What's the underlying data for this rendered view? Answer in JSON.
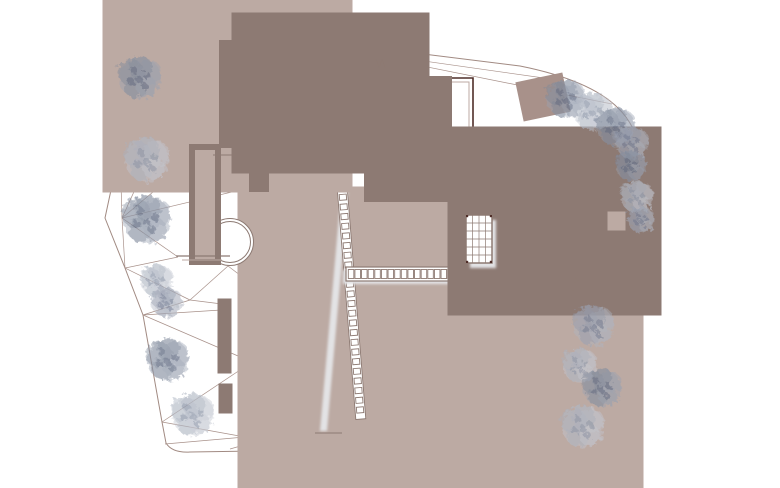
{
  "canvas": {
    "width": 780,
    "height": 488,
    "background": "#ffffff"
  },
  "palette": {
    "bound": "#a18a82",
    "mesh": "#a8918a",
    "dark": "#4f2e29",
    "med": "#8d7a73",
    "light": "#bcaaa3",
    "shadow": "#e3e3e5",
    "poolshadow": "#d9d9db",
    "white": "#ffffff",
    "tree_light": [
      "#c3c8d2",
      "#aab1bf",
      "#8a93a6"
    ],
    "tree_mid": [
      "#b0b6c2",
      "#949cad",
      "#6f7990"
    ],
    "tree_dark": [
      "#9aa2b2",
      "#7e8799",
      "#5c667e"
    ]
  },
  "site": {
    "boundary_path": "M132,18 L520,66 Q590,80 618,108 Q643,132 643,178 Q643,230 634,282 Q627,330 612,387 Q601,424 566,440 Q552,447 536,447 L190,452 Q172,453 166,443 L162,422 L143,315 L125,268 L105,218 L120,148 Z",
    "mesh_segments": [
      [
        132,
        18,
        233,
        28
      ],
      [
        233,
        28,
        612,
        104
      ],
      [
        132,
        18,
        346,
        50
      ],
      [
        346,
        50,
        558,
        80
      ],
      [
        233,
        28,
        384,
        57
      ],
      [
        233,
        28,
        165,
        58
      ],
      [
        233,
        28,
        290,
        60
      ],
      [
        290,
        60,
        346,
        50
      ],
      [
        132,
        18,
        131,
        58
      ],
      [
        131,
        58,
        165,
        58
      ],
      [
        131,
        58,
        120,
        148
      ],
      [
        131,
        58,
        163,
        128
      ],
      [
        165,
        58,
        163,
        128
      ],
      [
        163,
        128,
        120,
        148
      ],
      [
        163,
        128,
        122,
        218
      ],
      [
        120,
        148,
        122,
        218
      ],
      [
        122,
        218,
        197,
        155
      ],
      [
        122,
        218,
        253,
        187
      ],
      [
        122,
        218,
        178,
        257
      ],
      [
        122,
        218,
        125,
        268
      ],
      [
        125,
        268,
        190,
        300
      ],
      [
        190,
        300,
        143,
        315
      ],
      [
        190,
        300,
        222,
        304
      ],
      [
        190,
        300,
        228,
        266
      ],
      [
        143,
        315,
        221,
        310
      ],
      [
        143,
        315,
        252,
        362
      ],
      [
        162,
        422,
        252,
        362
      ],
      [
        162,
        422,
        245,
        437
      ],
      [
        165,
        444,
        245,
        437
      ],
      [
        245,
        437,
        310,
        416
      ],
      [
        310,
        416,
        253,
        433
      ],
      [
        230,
        449,
        300,
        429
      ],
      [
        300,
        429,
        347,
        442
      ],
      [
        347,
        442,
        425,
        427
      ],
      [
        425,
        427,
        487,
        441
      ],
      [
        487,
        441,
        545,
        430
      ],
      [
        228,
        266,
        270,
        298
      ],
      [
        178,
        257,
        125,
        268
      ]
    ]
  },
  "scene": [
    {
      "name": "terrace-upper-shadow",
      "t": "poly",
      "pts": "298,277 392,277 392,288 298,288",
      "f": "shadow",
      "blur": 1
    },
    {
      "name": "terrace-slab-shadow",
      "t": "poly",
      "pts": "252,433 558,430 558,440 248,442",
      "f": "shadow",
      "blur": 1
    },
    {
      "name": "terrace-slab",
      "t": "poly",
      "pts": "273,291 334,288 558,288 558,430 252,433",
      "f": "#ffffff",
      "c": "light"
    },
    {
      "name": "terrace-top-edge",
      "t": "line",
      "p": [
        298,
        288,
        334,
        287
      ],
      "c": "dark",
      "w": 1.2
    },
    {
      "name": "terrace-left-inner-edge",
      "t": "line",
      "p": [
        276,
        295,
        256,
        429
      ],
      "c": "light"
    },
    {
      "name": "pool-shadow",
      "t": "path",
      "d": "M334,417 H547 V295 L563,307 V439 H316 Z",
      "f": "poolshadow",
      "blur": 2
    },
    {
      "name": "pool",
      "t": "rect",
      "x": 334,
      "y": 283,
      "w": 213,
      "h": 134,
      "c": "dark",
      "sw": 2.4,
      "f": "#ffffff"
    },
    {
      "name": "pool-inner-edge",
      "t": "rect",
      "x": 339,
      "y": 288,
      "w": 203,
      "h": 124,
      "c": "light"
    },
    {
      "name": "main-stair-shadow",
      "t": "poly",
      "pts": "345,148 352,148 327,431 320,431",
      "f": "shadow",
      "blur": 1
    },
    {
      "name": "main-stair",
      "t": "ladder",
      "x": 338.5,
      "y": 142,
      "len": 278,
      "wd": 10,
      "tilt": -4.6,
      "rungs": 28,
      "c": "med"
    },
    {
      "name": "garden-steps-shadow",
      "t": "rect",
      "x": 343,
      "y": 270,
      "w": 109,
      "h": 14,
      "f": "shadow",
      "blur": 1
    },
    {
      "name": "garden-steps",
      "t": "strip",
      "x": 346,
      "y": 267,
      "w": 109,
      "h": 14,
      "cells": 16,
      "c": "med"
    },
    {
      "name": "lower-steps-1",
      "t": "line",
      "p": [
        315,
        433,
        342,
        433
      ],
      "c": "med"
    },
    {
      "name": "lower-steps-2",
      "t": "line",
      "p": [
        318,
        436,
        339,
        436
      ],
      "c": "light"
    },
    {
      "name": "lower-steps-3",
      "t": "line",
      "p": [
        321,
        439,
        336,
        439
      ],
      "c": "light"
    },
    {
      "name": "annex-outline",
      "t": "rect",
      "x": 165,
      "y": 60,
      "w": 125,
      "h": 70,
      "c": "light"
    },
    {
      "name": "annex-division",
      "t": "rect",
      "x": 238,
      "y": 59,
      "w": 38,
      "h": 70,
      "c": "med"
    },
    {
      "name": "building-a-shadow",
      "t": "rect",
      "x": 287,
      "y": 70,
      "w": 107,
      "h": 70,
      "f": "shadow",
      "blur": 1
    },
    {
      "name": "building-a",
      "t": "rect",
      "x": 277,
      "y": 58,
      "w": 107,
      "h": 70,
      "c": "dark",
      "sw": 1.8,
      "f": "#ffffff"
    },
    {
      "name": "building-a-inner",
      "t": "rect",
      "x": 281,
      "y": 62,
      "w": 99,
      "h": 62,
      "c": "med"
    },
    {
      "name": "entry-steps",
      "t": "rect",
      "x": 386,
      "y": 60,
      "w": 22,
      "h": 16,
      "c": "med",
      "f": "#ffffff"
    },
    {
      "name": "entry-steps-2",
      "t": "rect",
      "x": 389,
      "y": 63,
      "w": 16,
      "h": 10,
      "c": "med"
    },
    {
      "name": "entry-steps-3",
      "t": "rect",
      "x": 392,
      "y": 66,
      "w": 10,
      "h": 4,
      "c": "med"
    },
    {
      "name": "entry-mark",
      "t": "polyline",
      "pts": "376,59 379,68 382,59 385,68",
      "c": "med",
      "w": 0.8
    },
    {
      "name": "roof-edge",
      "t": "polyline",
      "pts": "384,78 473,78 473,177",
      "c": "dark",
      "w": 1.6
    },
    {
      "name": "roof-edge-inner",
      "t": "polyline",
      "pts": "384,82 469,82 469,177",
      "c": "light"
    },
    {
      "name": "stair-hall-shadow",
      "t": "rect",
      "x": 392,
      "y": 106,
      "w": 44,
      "h": 82,
      "f": "shadow",
      "blur": 1
    },
    {
      "name": "stair-hall",
      "t": "rect",
      "x": 386,
      "y": 98,
      "w": 44,
      "h": 82,
      "c": "med",
      "f": "#ffffff"
    },
    {
      "name": "flue-line",
      "t": "polyline",
      "pts": "500,146 511,146 511,177",
      "c": "med"
    },
    {
      "name": "building-b-shadow",
      "t": "rect",
      "x": 505,
      "y": 188,
      "w": 115,
      "h": 90,
      "f": "shadow",
      "blur": 1
    },
    {
      "name": "building-b",
      "t": "rect",
      "x": 497,
      "y": 176,
      "w": 115,
      "h": 90,
      "c": "dark",
      "sw": 1.8,
      "f": "#ffffff"
    },
    {
      "name": "building-b-inner",
      "t": "rect",
      "x": 501,
      "y": 180,
      "w": 107,
      "h": 82,
      "c": "med"
    },
    {
      "name": "building-b-notch",
      "t": "rect",
      "x": 612,
      "y": 216,
      "w": 9,
      "h": 10,
      "c": "light",
      "f": "#ffffff"
    },
    {
      "name": "skylight-shadow",
      "t": "rect",
      "x": 470,
      "y": 220,
      "w": 26,
      "h": 48,
      "f": "shadow",
      "blur": 1
    },
    {
      "name": "skylight-grid",
      "t": "grid",
      "x": 466,
      "y": 215,
      "w": 26,
      "h": 48,
      "cols": 4,
      "rows": 6,
      "c": "med"
    },
    {
      "name": "stair-b-rail",
      "t": "line",
      "p": [
        585,
        262,
        585,
        310
      ],
      "c": "med"
    },
    {
      "name": "stair-b",
      "t": "rect",
      "x": 563,
      "y": 276,
      "w": 6,
      "h": 28,
      "c": "med",
      "f": "#ffffff"
    },
    {
      "name": "stair-b-rung-1",
      "t": "line",
      "p": [
        563,
        285,
        569,
        285
      ],
      "c": "med"
    },
    {
      "name": "stair-b-rung-2",
      "t": "line",
      "p": [
        563,
        294,
        569,
        294
      ],
      "c": "med"
    },
    {
      "name": "stair-b-frame",
      "t": "polyline",
      "pts": "572,296 577,275 582,296",
      "c": "med"
    },
    {
      "name": "stair-b-bar",
      "t": "line",
      "p": [
        573,
        285,
        581,
        285
      ],
      "c": "med"
    },
    {
      "name": "stair-b-tick",
      "t": "line",
      "p": [
        556,
        283,
        563,
        283
      ],
      "c": "med"
    },
    {
      "name": "gate-outline",
      "t": "rect",
      "x": 531,
      "y": 89,
      "w": 24,
      "h": 16,
      "c": "mesh",
      "rot": [
        -12,
        543,
        97
      ]
    },
    {
      "name": "spiral-court",
      "t": "circle",
      "cx": 230,
      "cy": 242,
      "r": 23.5,
      "c": "med",
      "f": "#ffffff"
    },
    {
      "name": "spiral-court-inner",
      "t": "circle",
      "cx": 230,
      "cy": 242,
      "r": 20.5,
      "c": "med"
    },
    {
      "name": "garden-wall",
      "t": "rect",
      "x": 197,
      "y": 152,
      "w": 16,
      "h": 105,
      "c": "med",
      "f": "#ffffff"
    },
    {
      "name": "garden-wall-inner",
      "t": "rect",
      "x": 200,
      "y": 155,
      "w": 10,
      "h": 99,
      "c": "light"
    },
    {
      "name": "garden-pier",
      "t": "rect",
      "x": 254,
      "y": 152,
      "w": 10,
      "h": 35,
      "c": "med",
      "f": "#ffffff"
    },
    {
      "name": "wall-connector",
      "t": "line",
      "p": [
        213,
        155,
        254,
        155
      ],
      "c": "med"
    },
    {
      "name": "bench",
      "t": "line",
      "p": [
        176,
        256,
        230,
        256
      ],
      "c": "med",
      "w": 1.2
    },
    {
      "name": "bench-shadow-line",
      "t": "line",
      "p": [
        182,
        260,
        222,
        260
      ],
      "c": "light"
    },
    {
      "name": "retaining-wall-a",
      "t": "rect",
      "x": 221,
      "y": 302,
      "w": 7,
      "h": 68,
      "c": "med",
      "f": "#ffffff"
    },
    {
      "name": "retaining-wall-b",
      "t": "rect",
      "x": 222,
      "y": 387,
      "w": 7,
      "h": 23,
      "c": "med",
      "f": "#ffffff"
    }
  ],
  "trees": [
    {
      "cx": 140,
      "cy": 78,
      "r": 21,
      "tone": "dark"
    },
    {
      "cx": 147,
      "cy": 160,
      "r": 22,
      "tone": "light"
    },
    {
      "cx": 147,
      "cy": 220,
      "r": 24,
      "tone": "dark"
    },
    {
      "cx": 157,
      "cy": 281,
      "r": 16,
      "tone": "light"
    },
    {
      "cx": 167,
      "cy": 303,
      "r": 15,
      "tone": "mid"
    },
    {
      "cx": 168,
      "cy": 360,
      "r": 21,
      "tone": "dark"
    },
    {
      "cx": 193,
      "cy": 415,
      "r": 21,
      "tone": "light"
    },
    {
      "cx": 566,
      "cy": 99,
      "r": 19,
      "tone": "dark"
    },
    {
      "cx": 593,
      "cy": 112,
      "r": 19,
      "tone": "light"
    },
    {
      "cx": 616,
      "cy": 127,
      "r": 19,
      "tone": "dark"
    },
    {
      "cx": 632,
      "cy": 143,
      "r": 16,
      "tone": "mid"
    },
    {
      "cx": 631,
      "cy": 166,
      "r": 15,
      "tone": "dark"
    },
    {
      "cx": 637,
      "cy": 197,
      "r": 16,
      "tone": "light"
    },
    {
      "cx": 641,
      "cy": 220,
      "r": 13,
      "tone": "mid"
    },
    {
      "cx": 594,
      "cy": 326,
      "r": 20,
      "tone": "mid"
    },
    {
      "cx": 580,
      "cy": 366,
      "r": 17,
      "tone": "light"
    },
    {
      "cx": 602,
      "cy": 388,
      "r": 19,
      "tone": "dark"
    },
    {
      "cx": 583,
      "cy": 427,
      "r": 21,
      "tone": "light"
    }
  ]
}
